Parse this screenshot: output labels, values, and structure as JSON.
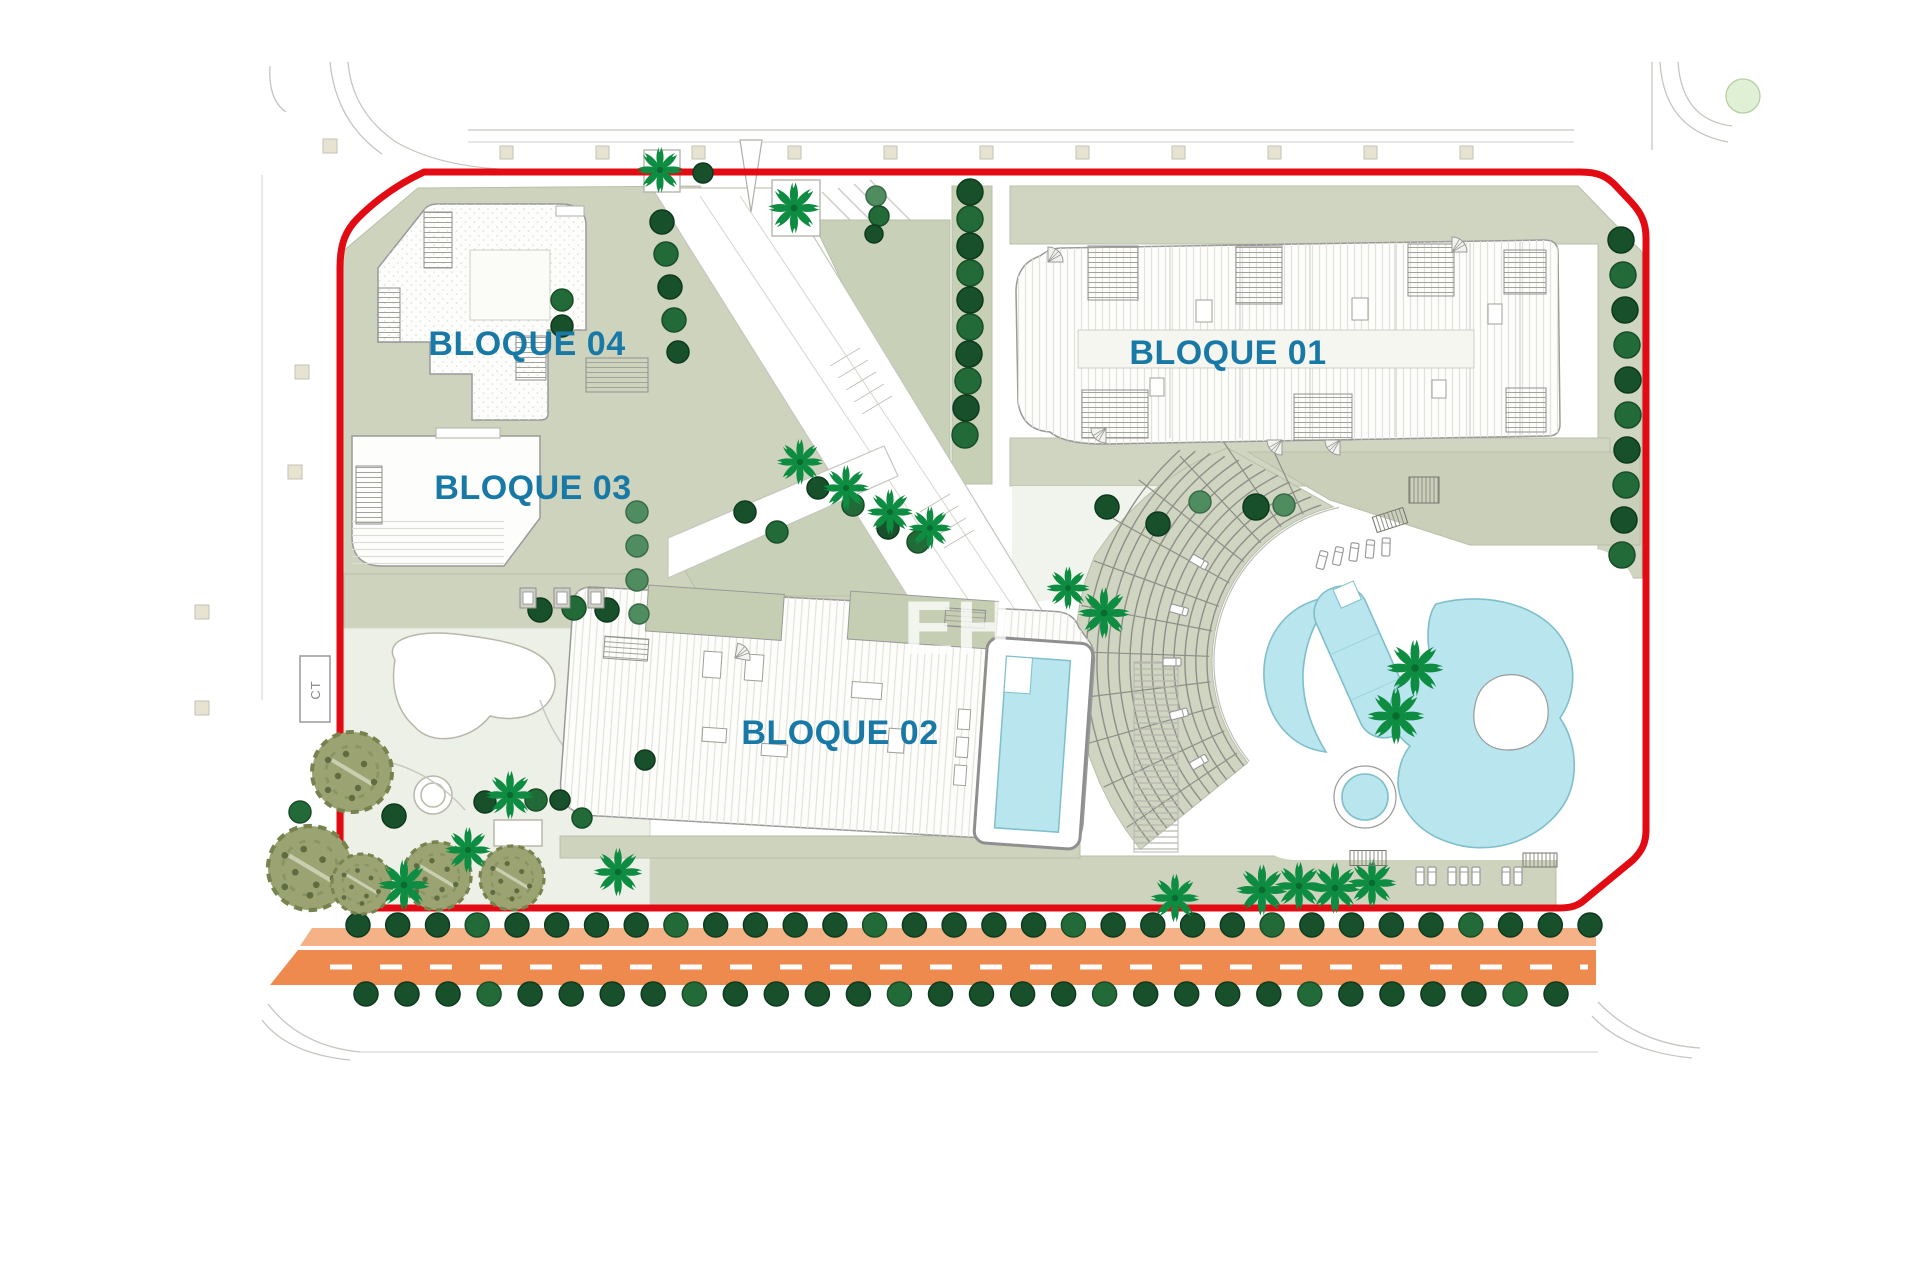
{
  "plan": {
    "labels": {
      "block01": "BLOQUE 01",
      "block02": "BLOQUE 02",
      "block03": "BLOQUE 03",
      "block04": "BLOQUE 04",
      "transformer": "CT",
      "watermark": "EH"
    },
    "colors": {
      "boundary_red": "#e30b13",
      "road_orange": "#ef8a4f",
      "road_light_orange": "#f6b287",
      "pool_cyan": "#b9e5ee",
      "sage_green": "#cdd3bd",
      "tree_dark_green": "#17502a",
      "palm_green": "#0e8c41",
      "label_blue": "#1878a6"
    },
    "amphitheater": {
      "cx": 1372,
      "cy": 662,
      "r_inner": 160,
      "r_step_min": 165,
      "r_step_count": 12,
      "r_step_gap": 11
    },
    "landscape": {
      "round_trees": [
        [
          662,
          222,
          12,
          0
        ],
        [
          666,
          254,
          12,
          1
        ],
        [
          670,
          287,
          12,
          0
        ],
        [
          674,
          320,
          12,
          1
        ],
        [
          678,
          352,
          11,
          0
        ],
        [
          562,
          300,
          11,
          1
        ],
        [
          562,
          326,
          11,
          0
        ],
        [
          876,
          196,
          10,
          2
        ],
        [
          879,
          216,
          10,
          1
        ],
        [
          874,
          234,
          9,
          0
        ],
        [
          703,
          173,
          10,
          0
        ],
        [
          970,
          192,
          13,
          0
        ],
        [
          970,
          219,
          13,
          1
        ],
        [
          970,
          246,
          13,
          0
        ],
        [
          970,
          273,
          13,
          1
        ],
        [
          970,
          300,
          13,
          0
        ],
        [
          970,
          327,
          13,
          1
        ],
        [
          969,
          354,
          13,
          0
        ],
        [
          968,
          381,
          13,
          1
        ],
        [
          966,
          408,
          13,
          0
        ],
        [
          965,
          435,
          13,
          1
        ],
        [
          745,
          512,
          11,
          0
        ],
        [
          777,
          532,
          11,
          1
        ],
        [
          818,
          488,
          11,
          0
        ],
        [
          853,
          505,
          11,
          1
        ],
        [
          888,
          528,
          11,
          0
        ],
        [
          918,
          542,
          11,
          1
        ],
        [
          637,
          512,
          11,
          2
        ],
        [
          637,
          546,
          11,
          2
        ],
        [
          637,
          580,
          11,
          2
        ],
        [
          639,
          614,
          10,
          2
        ],
        [
          540,
          610,
          12,
          0
        ],
        [
          574,
          608,
          12,
          1
        ],
        [
          607,
          610,
          12,
          0
        ],
        [
          1107,
          507,
          12,
          0
        ],
        [
          1158,
          524,
          12,
          0
        ],
        [
          1200,
          502,
          11,
          2
        ],
        [
          1256,
          507,
          13,
          0
        ],
        [
          1284,
          505,
          11,
          2
        ],
        [
          1621,
          240,
          13,
          0
        ],
        [
          1623,
          275,
          13,
          1
        ],
        [
          1625,
          310,
          13,
          0
        ],
        [
          1627,
          345,
          13,
          1
        ],
        [
          1628,
          380,
          13,
          0
        ],
        [
          1628,
          415,
          13,
          1
        ],
        [
          1627,
          450,
          13,
          0
        ],
        [
          1626,
          485,
          13,
          1
        ],
        [
          1624,
          520,
          13,
          0
        ],
        [
          1622,
          555,
          13,
          1
        ],
        [
          394,
          816,
          12,
          0
        ],
        [
          300,
          812,
          11,
          1
        ],
        [
          485,
          802,
          11,
          0
        ],
        [
          536,
          800,
          11,
          1
        ],
        [
          560,
          800,
          10,
          0
        ],
        [
          582,
          818,
          10,
          1
        ],
        [
          645,
          760,
          10,
          0
        ]
      ],
      "tree_rows": [
        {
          "y": 925,
          "x1": 358,
          "x2": 1590,
          "n": 32,
          "r": 12
        },
        {
          "y": 994,
          "x1": 366,
          "x2": 1556,
          "n": 30,
          "r": 12
        }
      ],
      "palm_trees": [
        [
          794,
          208,
          0.95
        ],
        [
          660,
          170,
          0.85
        ],
        [
          800,
          462,
          0.85
        ],
        [
          846,
          488,
          0.85
        ],
        [
          890,
          512,
          0.85
        ],
        [
          930,
          528,
          0.8
        ],
        [
          1068,
          588,
          0.8
        ],
        [
          1104,
          613,
          0.95
        ],
        [
          1415,
          668,
          1.05
        ],
        [
          1396,
          716,
          1.05
        ],
        [
          510,
          795,
          0.9
        ],
        [
          404,
          885,
          0.95
        ],
        [
          468,
          850,
          0.85
        ],
        [
          618,
          872,
          0.9
        ],
        [
          1175,
          898,
          0.9
        ],
        [
          1262,
          890,
          0.95
        ],
        [
          1299,
          886,
          0.9
        ],
        [
          1335,
          888,
          0.95
        ],
        [
          1372,
          883,
          0.9
        ]
      ],
      "olive_trees": [
        [
          352,
          772,
          40
        ],
        [
          310,
          868,
          42
        ],
        [
          362,
          884,
          30
        ],
        [
          437,
          876,
          34
        ],
        [
          512,
          878,
          32
        ]
      ],
      "loungers": [
        [
          1199,
          762,
          60
        ],
        [
          1179,
          714,
          75
        ],
        [
          1172,
          662,
          90
        ],
        [
          1179,
          610,
          105
        ],
        [
          1199,
          562,
          120
        ],
        [
          1322,
          560,
          15
        ],
        [
          1338,
          556,
          12
        ],
        [
          1354,
          552,
          8
        ],
        [
          1370,
          549,
          5
        ],
        [
          1386,
          547,
          2
        ],
        [
          1420,
          876,
          0
        ],
        [
          1432,
          876,
          0
        ],
        [
          1452,
          876,
          0
        ],
        [
          1464,
          876,
          0
        ],
        [
          1476,
          876,
          0
        ],
        [
          1506,
          876,
          0
        ],
        [
          1518,
          876,
          0
        ]
      ],
      "benches": [
        [
          528,
          598
        ],
        [
          562,
          598
        ],
        [
          596,
          598
        ]
      ],
      "pergolas": [
        [
          1424,
          490,
          30,
          26,
          0
        ],
        [
          1368,
          858,
          36,
          15,
          0
        ],
        [
          1390,
          520,
          32,
          16,
          -18
        ],
        [
          1540,
          860,
          34,
          14,
          0
        ]
      ],
      "fans": [
        [
          1048,
          262,
          0
        ],
        [
          1106,
          428,
          180
        ],
        [
          1282,
          440,
          180
        ],
        [
          1340,
          440,
          180
        ],
        [
          735,
          658,
          10
        ],
        [
          1452,
          252,
          0
        ]
      ],
      "context_squares": [
        [
          302,
          372
        ],
        [
          295,
          472
        ],
        [
          202,
          612
        ],
        [
          202,
          708
        ],
        [
          330,
          146
        ]
      ],
      "square_row": {
        "y": 146,
        "x1": 500,
        "step": 96,
        "n": 11,
        "size": 13
      }
    }
  }
}
